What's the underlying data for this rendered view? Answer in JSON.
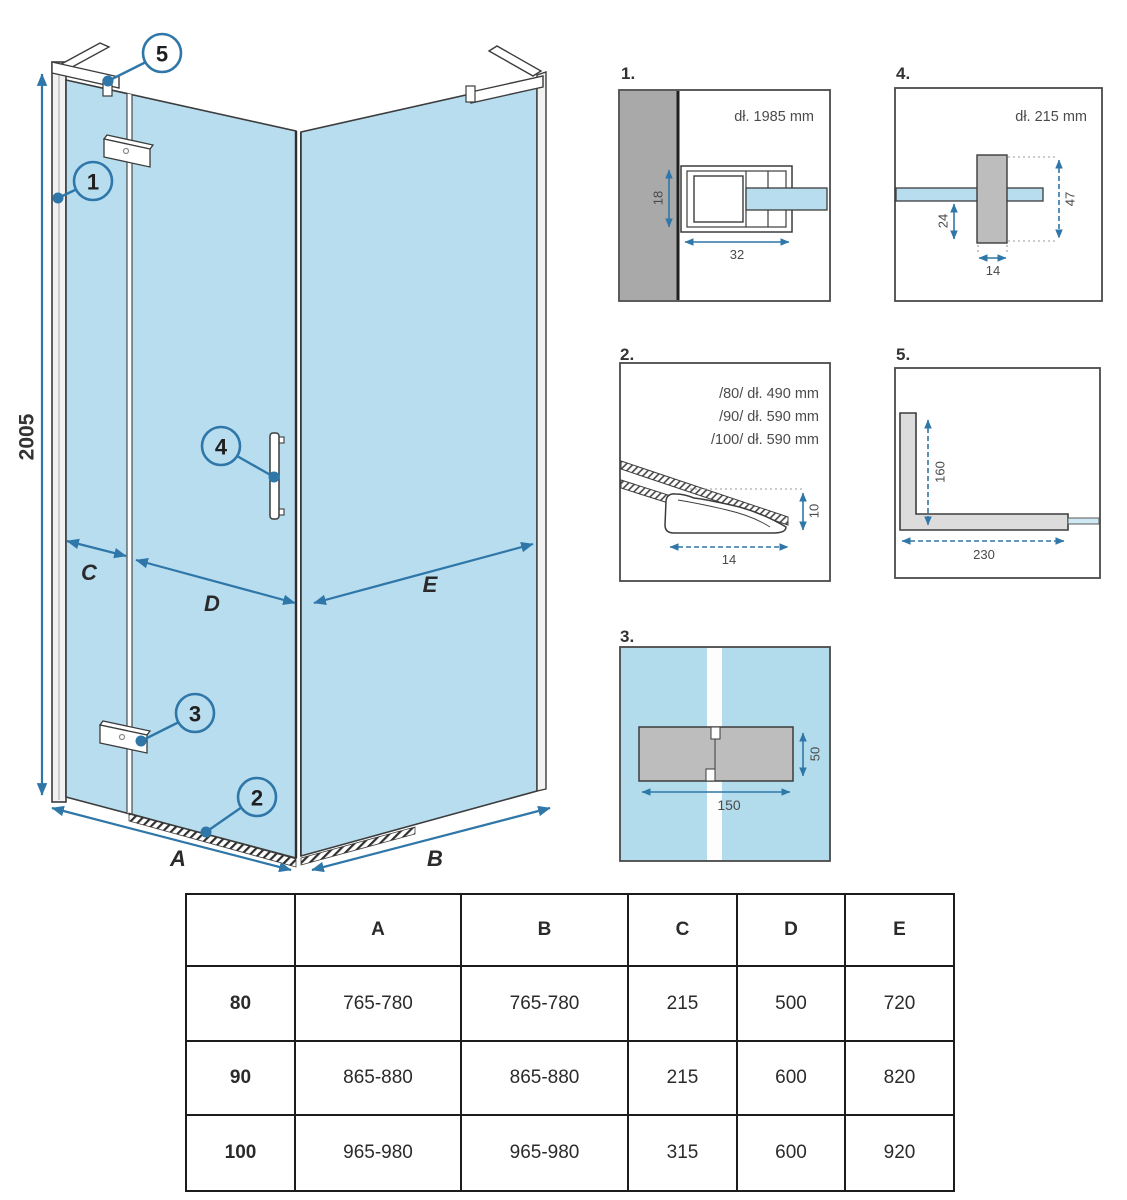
{
  "colors": {
    "glass": "#b7ddef",
    "detail3_bg": "#b2dcec",
    "wall_gray": "#a9a9a9",
    "part_gray": "#bdbdbd",
    "bracket_gray": "#dcdcdc",
    "line": "#3c3c3c",
    "dim_blue": "#2f77a8",
    "table_line": "#1c1c1c"
  },
  "main": {
    "height_label": "2005",
    "callouts": {
      "c1": "1",
      "c2": "2",
      "c3": "3",
      "c4": "4",
      "c5": "5"
    },
    "dims": {
      "a": "A",
      "b": "B",
      "c": "C",
      "d": "D",
      "e": "E"
    }
  },
  "details": {
    "d1": {
      "label": "1.",
      "length": "dł. 1985 mm",
      "dim_h": "18",
      "dim_w": "32"
    },
    "d2": {
      "label": "2.",
      "sizes": [
        "/80/ dł. 490 mm",
        "/90/ dł. 590 mm",
        "/100/ dł. 590 mm"
      ],
      "dim_h": "10",
      "dim_w": "14"
    },
    "d3": {
      "label": "3.",
      "dim_h": "50",
      "dim_w": "150"
    },
    "d4": {
      "label": "4.",
      "length": "dł. 215 mm",
      "dim_right": "47",
      "dim_left": "24",
      "dim_w": "14"
    },
    "d5": {
      "label": "5.",
      "dim_v": "160",
      "dim_h": "230"
    }
  },
  "table": {
    "col_headers": [
      "A",
      "B",
      "C",
      "D",
      "E"
    ],
    "rows": [
      {
        "label": "80",
        "values": [
          "765-780",
          "765-780",
          "215",
          "500",
          "720"
        ]
      },
      {
        "label": "90",
        "values": [
          "865-880",
          "865-880",
          "215",
          "600",
          "820"
        ]
      },
      {
        "label": "100",
        "values": [
          "965-980",
          "965-980",
          "315",
          "600",
          "920"
        ]
      }
    ]
  }
}
